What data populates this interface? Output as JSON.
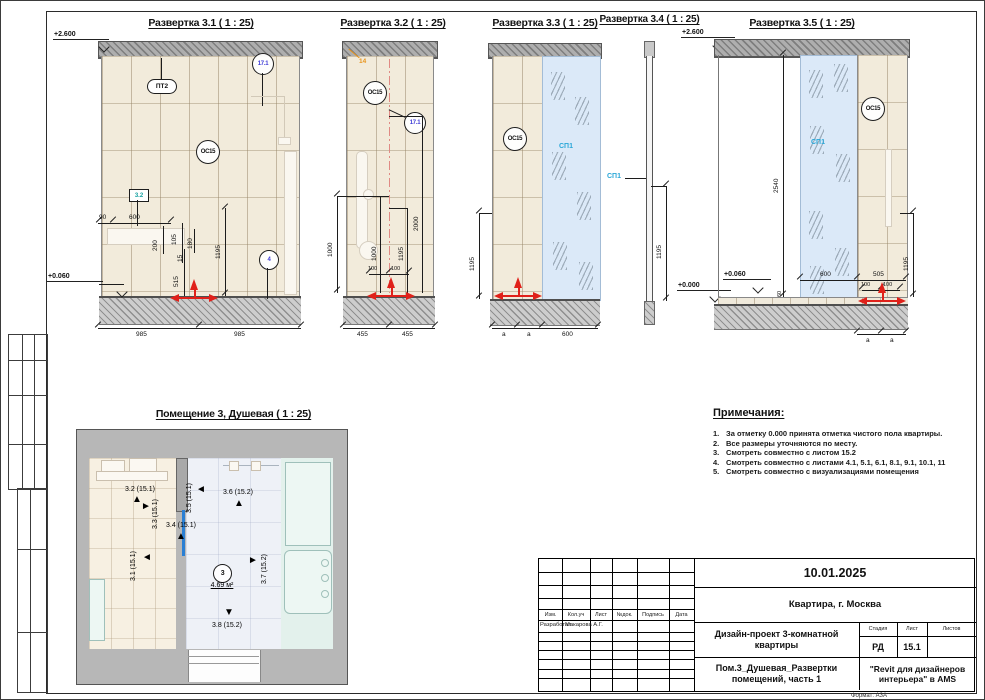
{
  "palette": {
    "accent_red": "#e0211a",
    "glass_blue": "#dbe9f8",
    "tile_beige": "#f2ebdb",
    "label_cyan": "#2aa7d8",
    "tag_blue": "#3d3bd6",
    "tag_teal": "#14a0a0",
    "marker_orange": "#e8941a"
  },
  "views": {
    "v31": {
      "title": "Развертка 3.1 ( 1 : 25)",
      "level_top": "+2.600",
      "level_floor": "+0.060",
      "tag_pt2": "ПТ2",
      "tag_os15": "ОС15",
      "tag_171": "17.1",
      "tag_32": "3.2",
      "tag_4": "4",
      "d90": "90",
      "d600": "600",
      "d200": "200",
      "d105": "105",
      "d180": "180",
      "d15": "15",
      "d515": "515",
      "d1195": "1195",
      "w985a": "985",
      "w985b": "985"
    },
    "v32": {
      "title": "Развертка 3.2 ( 1 : 25)",
      "tag_os15": "ОС15",
      "tag_171": "17.1",
      "tag_14": "14",
      "d1000a": "1000",
      "d1000b": "1000",
      "d1195": "1195",
      "d2000": "2000",
      "d100a": "100",
      "d100b": "100",
      "w455a": "455",
      "w455b": "455"
    },
    "v33": {
      "title": "Развертка 3.3 ( 1 : 25)",
      "tag_os15": "ОС15",
      "tag_sp1": "СП1",
      "d1195": "1195",
      "da1": "a",
      "da2": "a",
      "w600": "600"
    },
    "v34": {
      "title": "Развертка 3.4 ( 1 : 25)",
      "tag_sp1": "СП1",
      "d1195": "1195"
    },
    "v35": {
      "title": "Развертка 3.5 ( 1 : 25)",
      "level_top": "+2.600",
      "level_zero": "+0.000",
      "level_floor": "+0.060",
      "tag_os15": "ОС15",
      "tag_sp1": "СП1",
      "d2540": "2540",
      "d60": "60",
      "d600": "600",
      "d505": "505",
      "d100a": "100",
      "d100b": "100",
      "d1195": "1195",
      "da1": "a",
      "da2": "a"
    }
  },
  "plan": {
    "title": "Помещение 3, Душевая ( 1 : 25)",
    "room_number": "3",
    "room_area": "4.69 м²",
    "m31": "3.1 (15.1)",
    "m32": "3.2 (15.1)",
    "m33": "3.3 (15.1)",
    "m34": "3.4 (15.1)",
    "m35": "3.5 (15.1)",
    "m36": "3.6 (15.2)",
    "m37": "3.7 (15.2)",
    "m38": "3.8 (15.2)"
  },
  "notes": {
    "title": "Примечания:",
    "items": [
      {
        "n": "1.",
        "t": "За отметку 0.000 принята отметка чистого пола квартиры."
      },
      {
        "n": "2.",
        "t": "Все размеры уточняются по месту."
      },
      {
        "n": "3.",
        "t": "Смотреть совместно с листом 15.2"
      },
      {
        "n": "4.",
        "t": "Смотреть совместно с листами 4.1, 5.1, 6.1, 8.1, 9.1, 10.1, 11"
      },
      {
        "n": "5.",
        "t": "Смотреть совместно с визуализациями помещения"
      }
    ]
  },
  "titleblock": {
    "date": "10.01.2025",
    "location": "Квартира, г. Москва",
    "project": "Дизайн-проект 3-комнатной квартиры",
    "sheet_title": "Пом.3_Душевая_Развертки помещений, часть 1",
    "org": "\"Revit для дизайнеров интерьера\" в AMS",
    "col_izm": "Изм.",
    "col_koluch": "Кол.уч",
    "col_list": "Лист",
    "col_ndok": "№док.",
    "col_podpis": "Подпись",
    "col_data": "Дата",
    "row_role": "Разработал",
    "row_name": "Макарова А.Г.",
    "h_stage": "Стадия",
    "h_sheet": "Лист",
    "h_sheets": "Листов",
    "stage": "РД",
    "sheet_no": "15.1",
    "sheets_total": "",
    "format": "Формат: А3А"
  }
}
